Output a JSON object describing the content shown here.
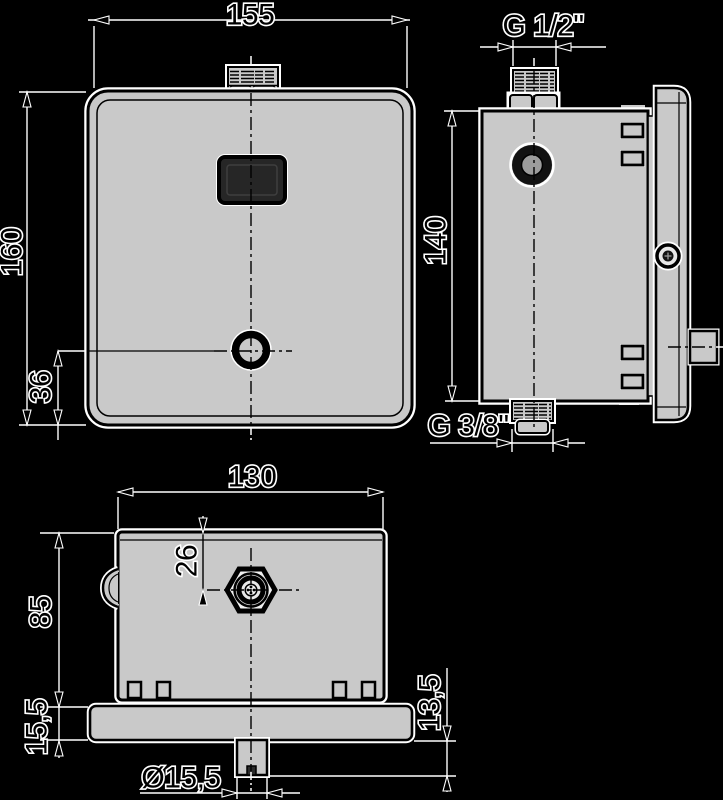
{
  "drawing": {
    "kind": "technical-dimension-drawing",
    "views": [
      "front",
      "side",
      "bottom"
    ]
  },
  "colors": {
    "background": "#000000",
    "body_fill": "#c9c9c9",
    "outline": "#000000",
    "halo": "#ffffff",
    "sensor_window_fill": "#262626"
  },
  "dims": {
    "front_width": "155",
    "front_height": "160",
    "button_offset": "36",
    "side_top_thread": "G 1/2\"",
    "side_height": "140",
    "side_bottom_thread": "G 3/8\"",
    "body_width": "130",
    "body_depth": "85",
    "connector_offset": "26",
    "plate_thickness": "15,5",
    "spout_protrusion": "13,5",
    "spout_diameter": "Ø15,5"
  }
}
